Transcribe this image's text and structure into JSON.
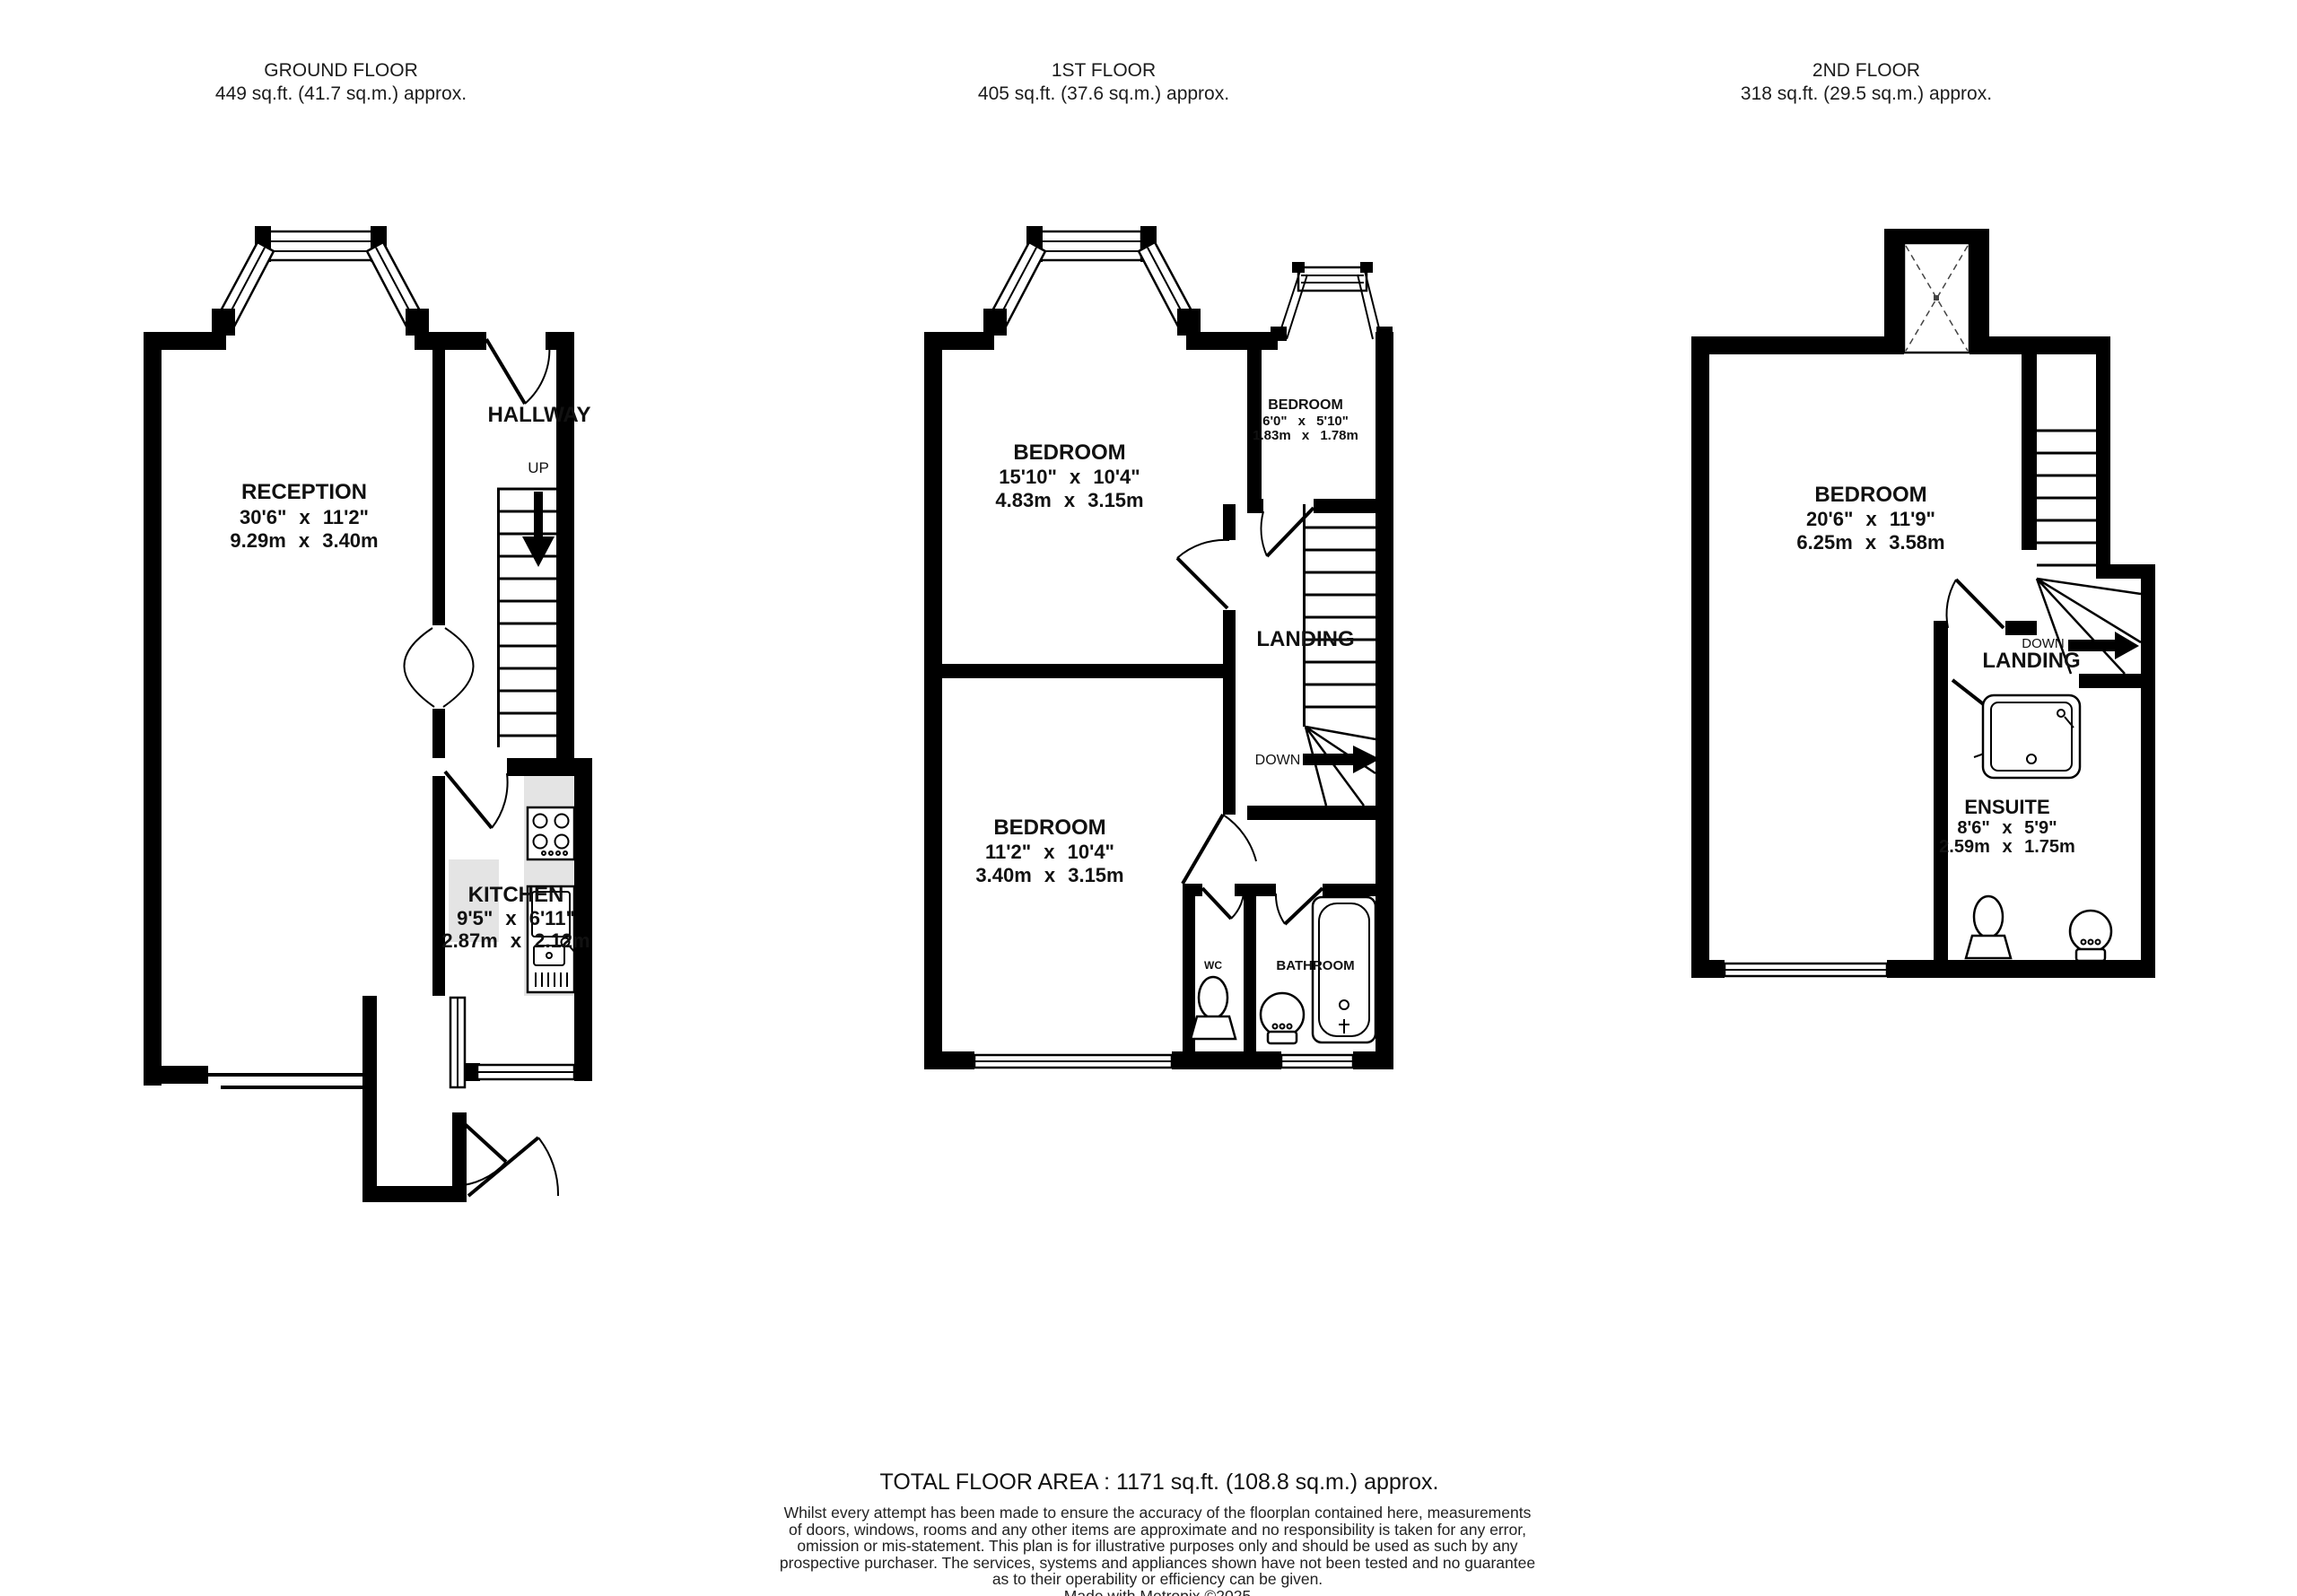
{
  "floors": [
    {
      "title": "GROUND FLOOR",
      "area": "449 sq.ft. (41.7 sq.m.) approx.",
      "rooms": {
        "reception": {
          "name": "RECEPTION",
          "imperial": "30'6\" x 11'2\"",
          "metric": "9.29m x 3.40m"
        },
        "hallway": {
          "name": "HALLWAY"
        },
        "kitchen": {
          "name": "KITCHEN",
          "imperial": "9'5\" x 6'11\"",
          "metric": "2.87m x 2.12m"
        }
      },
      "stairs": {
        "label": "UP"
      }
    },
    {
      "title": "1ST FLOOR",
      "area": "405 sq.ft. (37.6 sq.m.) approx.",
      "rooms": {
        "bedroom_front": {
          "name": "BEDROOM",
          "imperial": "15'10\" x 10'4\"",
          "metric": "4.83m x 3.15m"
        },
        "bedroom_small": {
          "name": "BEDROOM",
          "imperial": "6'0\" x 5'10\"",
          "metric": "1.83m x 1.78m"
        },
        "bedroom_back": {
          "name": "BEDROOM",
          "imperial": "11'2\" x 10'4\"",
          "metric": "3.40m x 3.15m"
        },
        "landing": {
          "name": "LANDING"
        },
        "wc": {
          "name": "WC"
        },
        "bathroom": {
          "name": "BATHROOM"
        }
      },
      "stairs": {
        "label": "DOWN"
      }
    },
    {
      "title": "2ND FLOOR",
      "area": "318 sq.ft. (29.5 sq.m.) approx.",
      "rooms": {
        "bedroom": {
          "name": "BEDROOM",
          "imperial": "20'6\" x 11'9\"",
          "metric": "6.25m x 3.58m"
        },
        "landing": {
          "name": "LANDING"
        },
        "ensuite": {
          "name": "ENSUITE",
          "imperial": "8'6\" x 5'9\"",
          "metric": "2.59m x 1.75m"
        }
      },
      "stairs": {
        "label": "DOWN"
      }
    }
  ],
  "footer": {
    "total": "TOTAL FLOOR AREA : 1171 sq.ft. (108.8 sq.m.) approx.",
    "disclaimer_lines": [
      "Whilst every attempt has been made to ensure the accuracy of the floorplan contained here, measurements",
      "of doors, windows, rooms and any other items are approximate and no responsibility is taken for any error,",
      "omission or mis-statement. This plan is for illustrative purposes only and should be used as such by any",
      "prospective purchaser. The services, systems and appliances shown have not been tested and no guarantee",
      "as to their operability or efficiency can be given."
    ],
    "credit": "Made with Metropix ©2025"
  }
}
